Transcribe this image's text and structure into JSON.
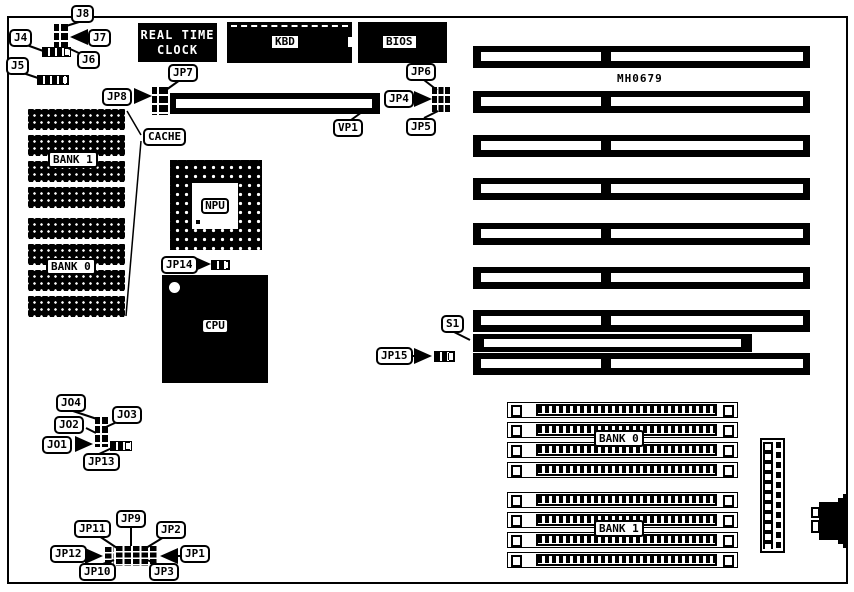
{
  "board": {
    "part_number": "MH0679",
    "colors": {
      "ink": "#000000",
      "paper": "#ffffff"
    },
    "chips": {
      "rtc_line1": "REAL TIME",
      "rtc_line2": "CLOCK",
      "kbd": "KBD",
      "bios": "BIOS",
      "npu": "NPU",
      "cpu": "CPU"
    },
    "memory": {
      "dip_bank1": "BANK 1",
      "dip_bank0": "BANK 0",
      "simm_bank0": "BANK 0",
      "simm_bank1": "BANK 1"
    },
    "callouts": {
      "j8": "J8",
      "j7": "J7",
      "j6": "J6",
      "j4": "J4",
      "j5": "J5",
      "jp7": "JP7",
      "jp8": "JP8",
      "vp1": "VP1",
      "jp6": "JP6",
      "jp4": "JP4",
      "jp5": "JP5",
      "cache": "CACHE",
      "jp14": "JP14",
      "s1": "S1",
      "jp15": "JP15",
      "jo4": "JO4",
      "jo3": "JO3",
      "jo2": "JO2",
      "jo1": "JO1",
      "jp13": "JP13",
      "jp11": "JP11",
      "jp9": "JP9",
      "jp2": "JP2",
      "jp12": "JP12",
      "jp1": "JP1",
      "jp10": "JP10",
      "jp3": "JP3"
    }
  }
}
